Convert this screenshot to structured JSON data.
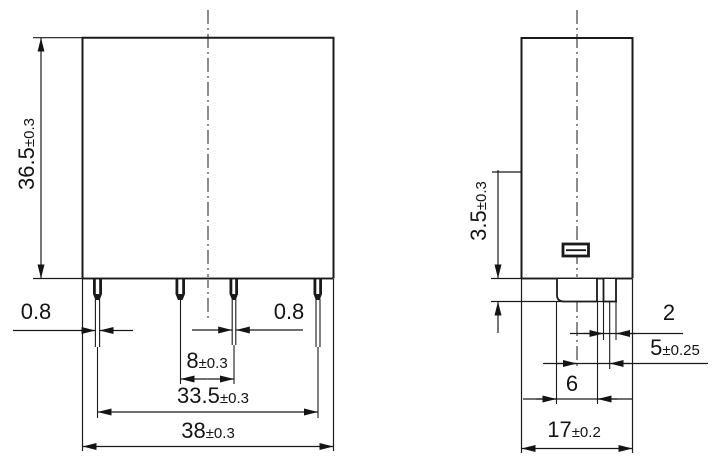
{
  "page": {
    "background": "#ffffff",
    "line_color": "#1a1a1a",
    "shadow_line_color": "#9b9b9b"
  },
  "front_view": {
    "name": "relay front view",
    "labels": {
      "height": {
        "value": "36.5",
        "tol": "±0.3"
      },
      "pin_width_left": {
        "value": "0.8",
        "tol": ""
      },
      "pin_width_right": {
        "value": "0.8",
        "tol": ""
      },
      "pin_pitch": {
        "value": "8",
        "tol": "±0.3"
      },
      "pin_span": {
        "value": "33.5",
        "tol": "±0.3"
      },
      "body_width": {
        "value": "38",
        "tol": "±0.3"
      }
    }
  },
  "side_view": {
    "name": "relay side view",
    "labels": {
      "terminal_standoff": {
        "value": "3.5",
        "tol": "±0.3"
      },
      "pin_thickness": {
        "value": "2",
        "tol": ""
      },
      "pin_offset": {
        "value": "5",
        "tol": "±0.25"
      },
      "blade_width": {
        "value": "6",
        "tol": ""
      },
      "body_depth": {
        "value": "17",
        "tol": "±0.2"
      }
    }
  }
}
